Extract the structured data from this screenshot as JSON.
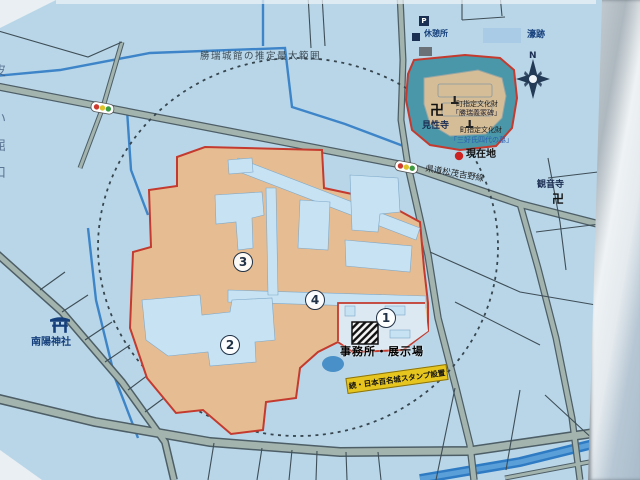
{
  "map": {
    "range_label": "勝瑞城館の推定最大範囲",
    "legend": {
      "moat_label": "濠跡"
    },
    "compass_label": "N",
    "rest_area_label": "休憩所",
    "parking_label": "P",
    "temples": {
      "kenshoji": "見性寺",
      "kannonji": "観音寺",
      "manji": "卍"
    },
    "shrine": {
      "nanyo": "南陽神社"
    },
    "cultural_property_1": {
      "line1": "町指定文化財",
      "line2": "「勝瑞義冢碑」"
    },
    "cultural_property_2": {
      "line1": "町指定文化財",
      "line2": "「三好氏四代の墓」"
    },
    "current_location_label": "現在地",
    "road_name": "県道松茂吉野線",
    "office_label": "事務所・展示場",
    "stamp_banner": "続・日本百名城スタンプ設置",
    "markers": [
      {
        "number": "1"
      },
      {
        "number": "2"
      },
      {
        "number": "3"
      },
      {
        "number": "4"
      }
    ],
    "edge_characters": [
      "皮",
      "い",
      "屈",
      "口"
    ],
    "colors": {
      "map_bg": "#b9d6e8",
      "site_fill": "#e6bd92",
      "site_border": "#c43a2e",
      "pond_water": "#4a97a9",
      "island_fill": "#d5bd97",
      "feature_blue": "#c6e2f3",
      "annex_fill": "#dde9f2",
      "road_fill": "#a3b4ae",
      "road_edge": "#4d5e66",
      "stream_blue": "#3d85c8",
      "river_blue": "#2e7bc4",
      "banner_yellow": "#e6c51e",
      "legend_swatch": "#a9cbe6"
    }
  }
}
